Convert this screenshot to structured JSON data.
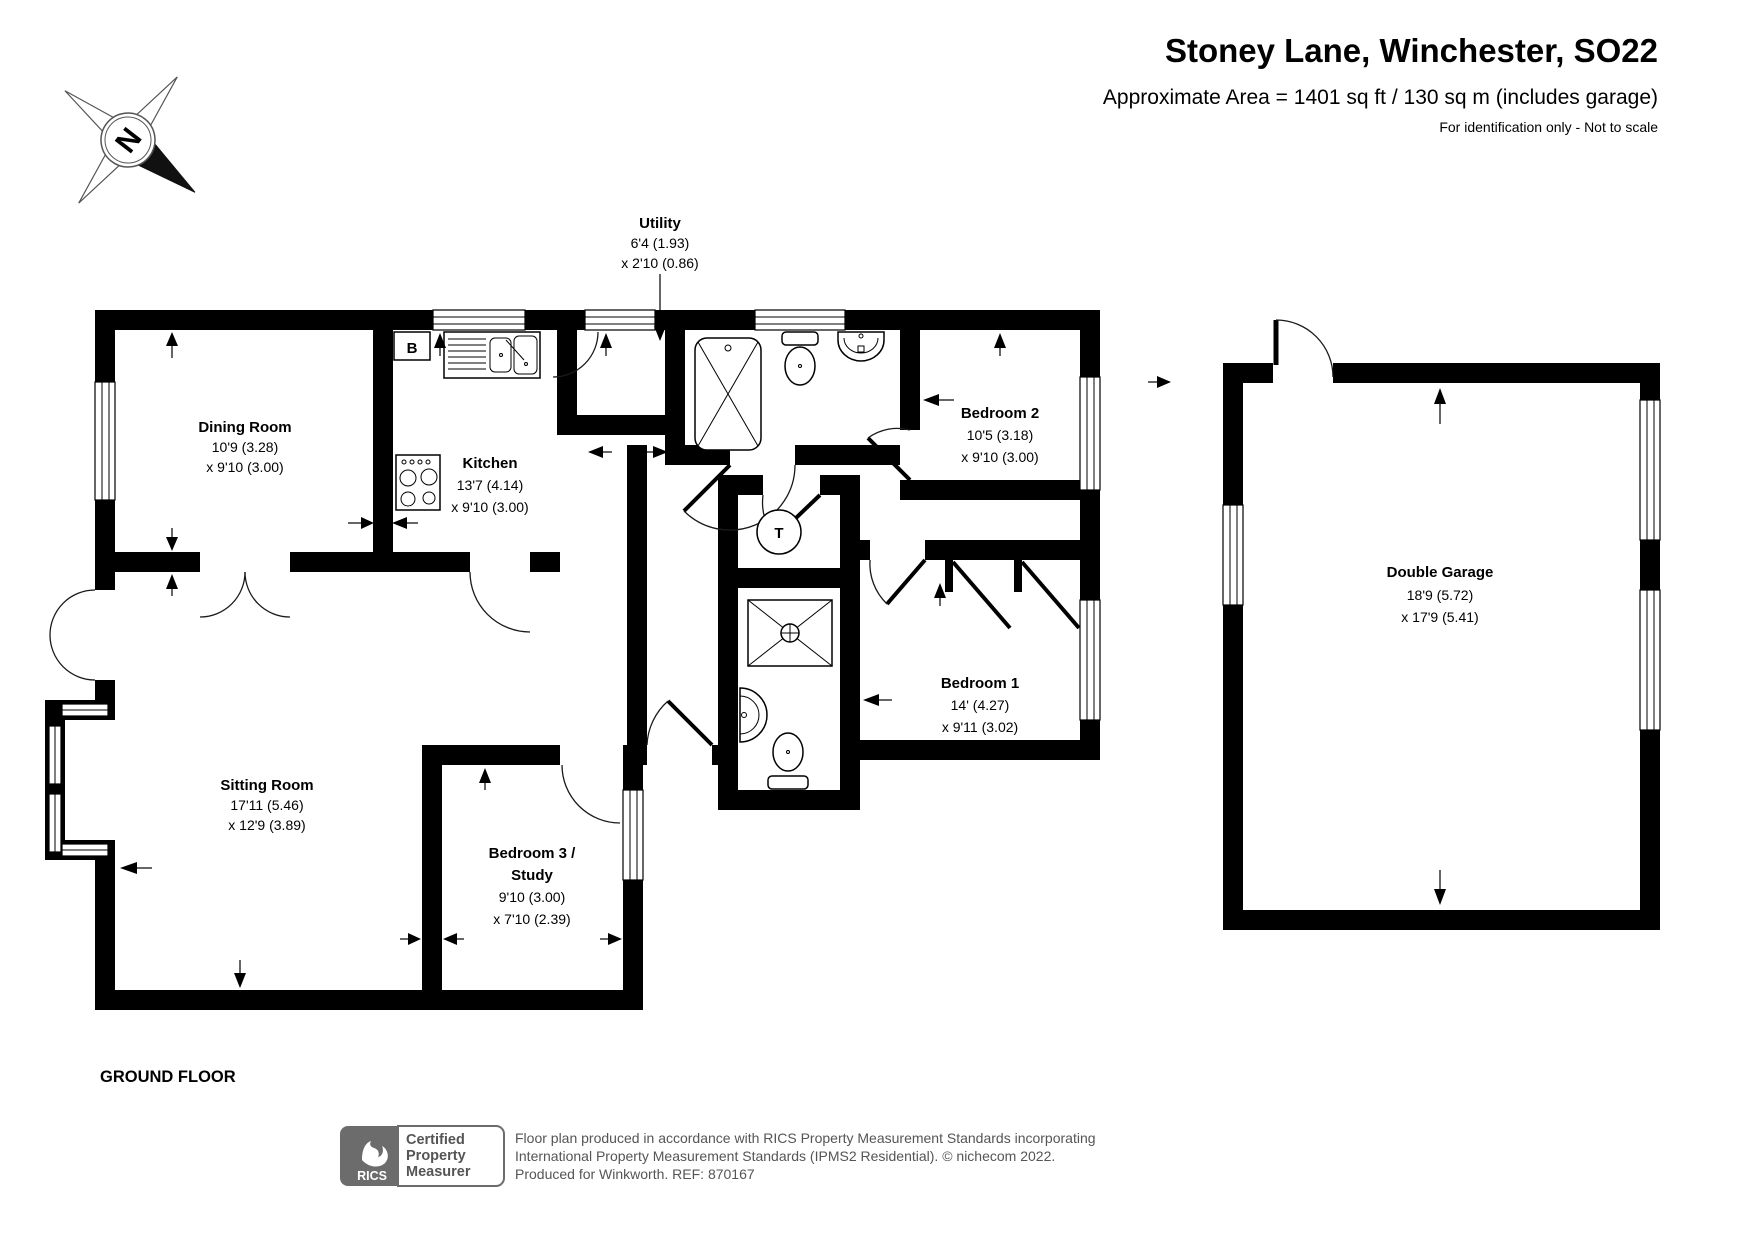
{
  "header": {
    "title": "Stoney Lane, Winchester, SO22",
    "subtitle": "Approximate Area = 1401 sq ft / 130 sq m (includes garage)",
    "note": "For identification only - Not to scale"
  },
  "compass": {
    "north": "N"
  },
  "floor_label": "GROUND FLOOR",
  "markers": {
    "boiler": "B",
    "tank": "T"
  },
  "rooms": {
    "dining": {
      "name": "Dining Room",
      "dim1": "10'9 (3.28)",
      "dim2": "x 9'10 (3.00)"
    },
    "kitchen": {
      "name": "Kitchen",
      "dim1": "13'7 (4.14)",
      "dim2": "x 9'10 (3.00)"
    },
    "utility": {
      "name": "Utility",
      "dim1": "6'4 (1.93)",
      "dim2": "x 2'10 (0.86)"
    },
    "bedroom2": {
      "name": "Bedroom 2",
      "dim1": "10'5 (3.18)",
      "dim2": "x 9'10 (3.00)"
    },
    "garage": {
      "name": "Double Garage",
      "dim1": "18'9 (5.72)",
      "dim2": "x 17'9 (5.41)"
    },
    "bedroom1": {
      "name": "Bedroom 1",
      "dim1": "14' (4.27)",
      "dim2": "x 9'11 (3.02)"
    },
    "sitting": {
      "name": "Sitting Room",
      "dim1": "17'11 (5.46)",
      "dim2": "x 12'9 (3.89)"
    },
    "bedroom3": {
      "name": "Bedroom 3 /",
      "name2": "Study",
      "dim1": "9'10 (3.00)",
      "dim2": "x 7'10 (2.39)"
    }
  },
  "footer": {
    "rics": "RICS",
    "cert_line1": "Certified",
    "cert_line2": "Property",
    "cert_line3": "Measurer",
    "line1": "Floor plan produced in accordance with RICS Property Measurement Standards incorporating",
    "line2": "International Property Measurement Standards (IPMS2 Residential).   © nichecom 2022.",
    "line3": "Produced for Winkworth.   REF: 870167"
  }
}
